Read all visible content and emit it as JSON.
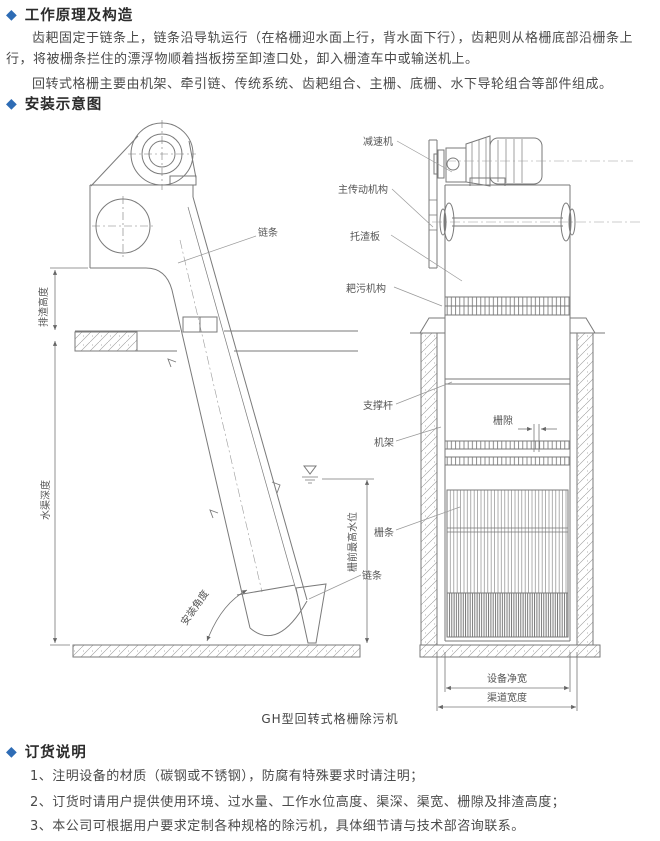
{
  "colors": {
    "accent_diamond": "#2e6cb5",
    "heading_text": "#2b2b2b",
    "body_text": "#4a4a4a",
    "drawing_line": "#7a7a7a"
  },
  "sections": {
    "principle": {
      "heading": "工作原理及构造",
      "paragraphs": [
        "齿耙固定于链条上，链条沿导轨运行（在格栅迎水面上行，背水面下行），齿耙则从格栅底部沿栅条上行，将被栅条拦住的漂浮物顺着挡板捞至卸渣口处，卸入栅渣车中或输送机上。",
        "回转式格栅主要由机架、牵引链、传统系统、齿耙组合、主栅、底栅、水下导轮组合等部件组成。"
      ]
    },
    "diagram": {
      "heading": "安装示意图",
      "caption": "GH型回转式格栅除污机",
      "labels": {
        "reducer": "减速机",
        "main_drive": "主传动机构",
        "slag_tray": "托渣板",
        "rake_mechanism": "耙污机构",
        "chain_upper": "链条",
        "support_rod": "支撑杆",
        "frame": "机架",
        "grid_gap": "栅隙",
        "grid_bar": "栅条",
        "chain_lower": "链条",
        "discharge_height": "排渣高度",
        "channel_depth": "水渠深度",
        "front_max_water_level": "栅前最高水位",
        "install_angle": "安装角度",
        "equipment_net_width": "设备净宽",
        "channel_width": "渠道宽度"
      }
    },
    "ordering": {
      "heading": "订货说明",
      "items": [
        "1、注明设备的材质（碳钢或不锈钢），防腐有特殊要求时请注明；",
        "2、订货时请用户提供使用环境、过水量、工作水位高度、渠深、渠宽、栅隙及排渣高度；",
        "3、本公司可根据用户要求定制各种规格的除污机，具体细节请与技术部咨询联系。"
      ]
    }
  }
}
